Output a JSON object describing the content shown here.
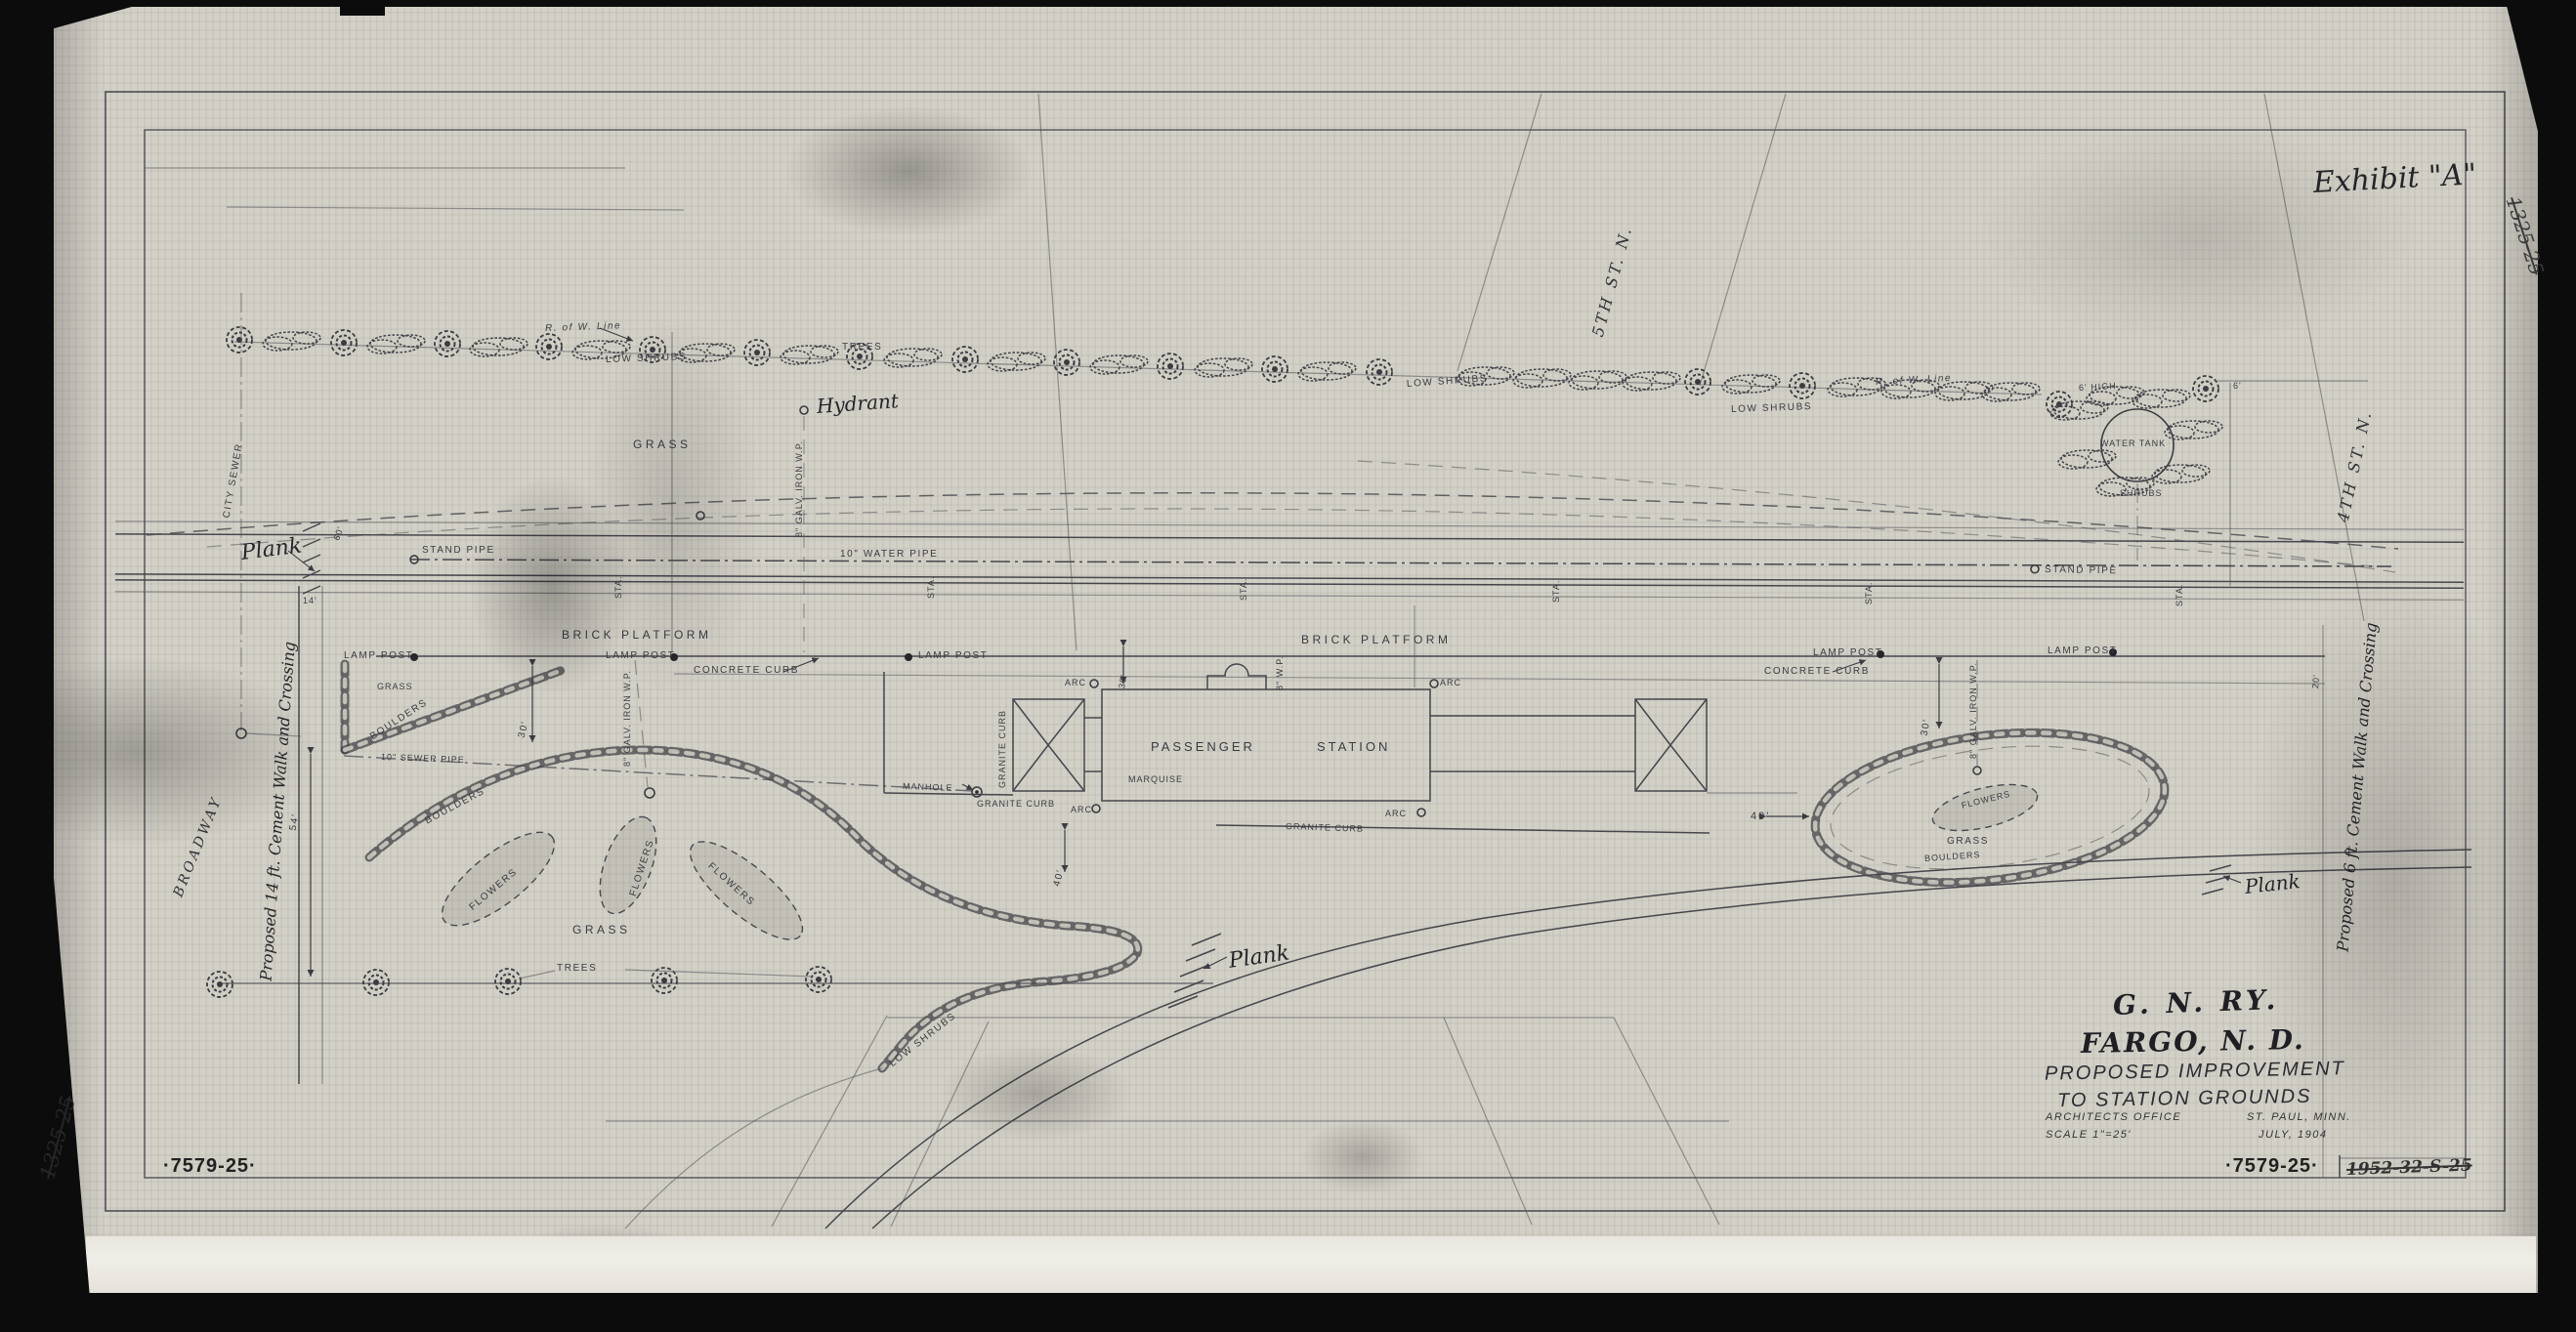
{
  "colors": {
    "paper": "#d3d0c7",
    "ink": "#3a3a40",
    "scan_bed": "#0d0d0d"
  },
  "annotations": {
    "exhibit": "Exhibit \"A\"",
    "file_left": "1325-25",
    "file_right": "1325-25",
    "superseded": "1952-32-S-25"
  },
  "title_block": {
    "railway": "G. N. RY.",
    "city": "FARGO, N. D.",
    "subtitle1": "PROPOSED IMPROVEMENT",
    "subtitle2": "TO STATION GROUNDS",
    "office": "ARCHITECTS OFFICE",
    "office_location": "ST. PAUL, MINN.",
    "scale": "SCALE 1\"=25'",
    "date": "JULY, 1904",
    "sheet_number": "·7579-25·"
  },
  "streets": {
    "fifth": "5TH ST. N.",
    "fourth": "4TH ST. N.",
    "broadway": "BROADWAY"
  },
  "walks": {
    "w14": "Proposed 14 ft. Cement Walk and Crossing",
    "w6": "Proposed 6 ft. Cement Walk and Crossing"
  },
  "vocab": {
    "r_of_w_line": "R. of W. Line",
    "low_shrubs": "LOW SHRUBS",
    "trees": "TREES",
    "grass": "GRASS",
    "flowers": "FLOWERS",
    "boulders": "BOULDERS",
    "brick_platform": "BRICK PLATFORM",
    "lamp_post": "LAMP POST",
    "concrete_curb": "CONCRETE CURB",
    "granite_curb": "GRANITE CURB",
    "stand_pipe": "STAND PIPE",
    "water_pipe": "10\" WATER PIPE",
    "sewer_pipe": "10\" SEWER PIPE",
    "city_sewer": "CITY SEWER",
    "manhole": "MANHOLE",
    "arc": "ARC",
    "sta": "STA.",
    "passenger": "PASSENGER",
    "station": "STATION",
    "water_tank": "WATER TANK",
    "shrubs": "SHRUBS",
    "high6": "6' HIGH",
    "galv": "8\" GALV. IRON W.P.",
    "wp8": "8\" W.P.",
    "marquise": "MARQUISE",
    "plank": "Plank",
    "hydrant": "Hydrant"
  },
  "dims": {
    "d6": "6'",
    "d14": "14'",
    "d20": "20'",
    "d30": "30'",
    "d40": "40'",
    "d54": "54'",
    "d60": "60'"
  }
}
